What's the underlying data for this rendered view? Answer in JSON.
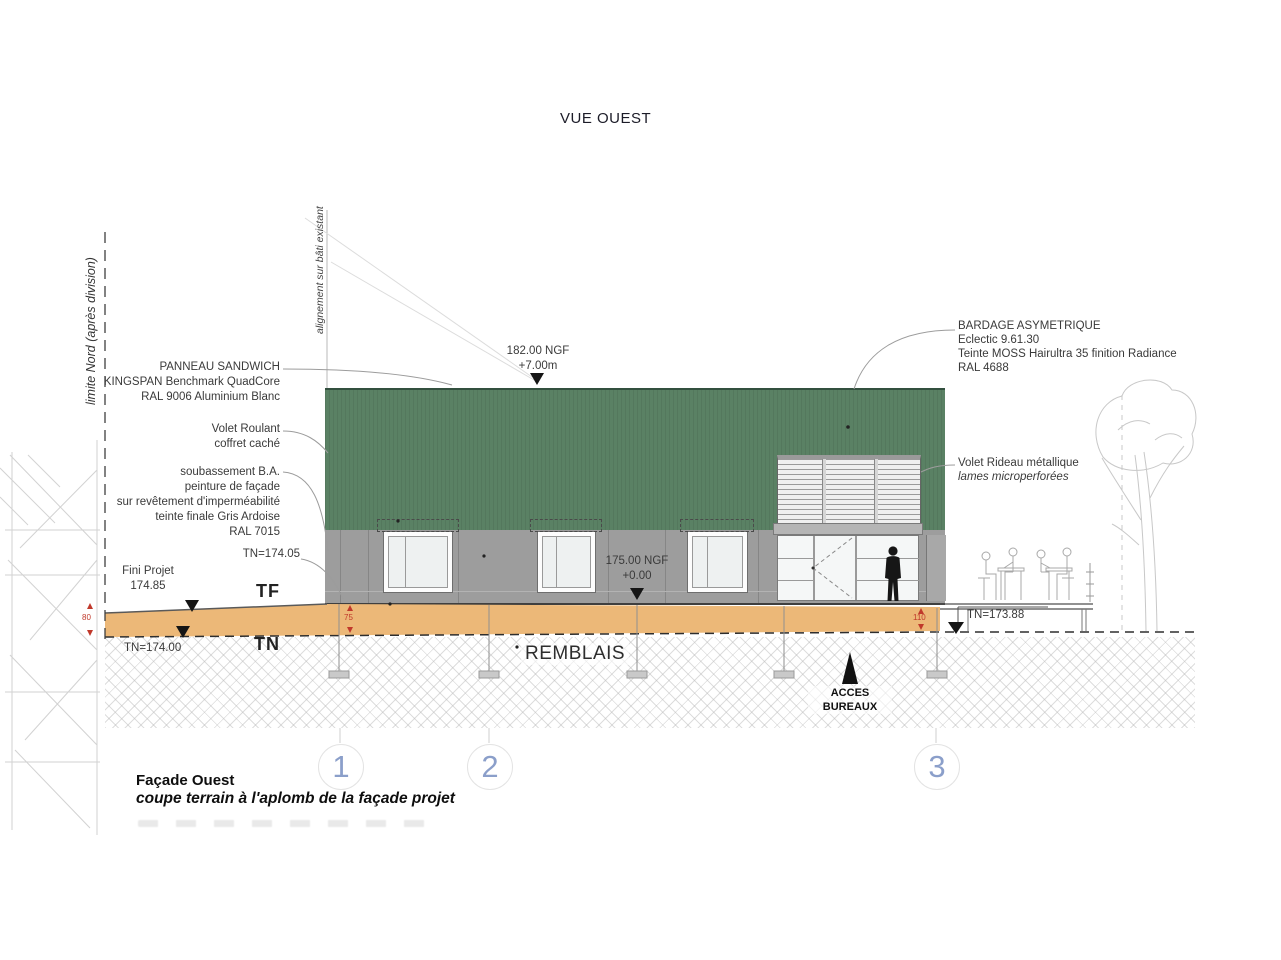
{
  "title": "VUE OUEST",
  "colors": {
    "facade_green": "#5a8164",
    "panel_gray": "#9d9d9d",
    "soil_orange": "#ecb878",
    "marker_red": "#c0392b",
    "bubble_blue": "#8b9fca"
  },
  "side_labels": {
    "limite_nord": "limite Nord (après division)",
    "alignement": "alignement sur bâti existant"
  },
  "callouts": {
    "panneau_sandwich": [
      "PANNEAU SANDWICH",
      "KINGSPAN Benchmark QuadCore",
      "RAL 9006 Aluminium Blanc"
    ],
    "volet_roulant": [
      "Volet Roulant",
      "coffret caché"
    ],
    "soubassement": [
      "soubassement B.A.",
      "peinture de façade",
      "sur revêtement d'imperméabilité",
      "teinte finale Gris Ardoise",
      "RAL 7015"
    ],
    "bardage": [
      "BARDAGE ASYMETRIQUE",
      "Eclectic 9.61.30",
      "Teinte MOSS Hairultra 35 finition Radiance",
      "RAL 4688"
    ],
    "volet_rideau": [
      "Volet Rideau métallique",
      "lames microperforées"
    ]
  },
  "levels": {
    "top": [
      "182.00 NGF",
      "+7.00m"
    ],
    "floor": [
      "175.00 NGF",
      "+0.00"
    ],
    "tn_174_05": "TN=174.05",
    "fini_projet": [
      "Fini Projet",
      "174.85"
    ],
    "tn_174_00": "TN=174.00",
    "tn_173_88": "TN=173.88",
    "tf": "TF",
    "tn": "TN"
  },
  "ground": {
    "remblais": "REMBLAIS",
    "acces": [
      "ACCES",
      "BUREAUX"
    ]
  },
  "dimensions": {
    "d80": "80",
    "d75": "75",
    "d110": "110"
  },
  "grid_bubbles": [
    "1",
    "2",
    "3"
  ],
  "footer": {
    "title": "Façade Ouest",
    "subtitle": "coupe terrain à l'aplomb de la façade projet"
  }
}
